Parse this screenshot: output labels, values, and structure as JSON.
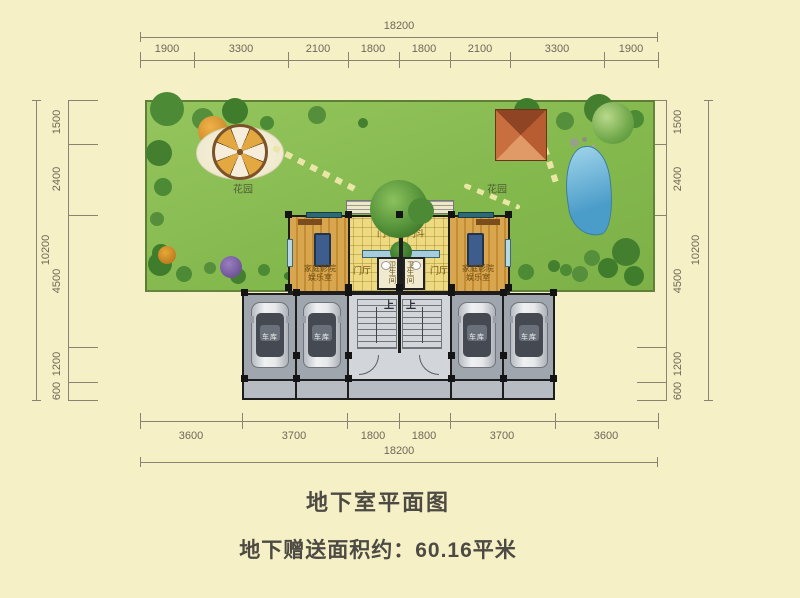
{
  "page": {
    "title": "地下室平面图",
    "subtitle": "地下赠送面积约：60.16平米"
  },
  "dims": {
    "top": {
      "overall": "18200",
      "segments": [
        "1900",
        "3300",
        "2100",
        "1800",
        "1800",
        "2100",
        "3300",
        "1900"
      ]
    },
    "bottom": {
      "overall": "18200",
      "segments": [
        "3600",
        "3700",
        "1800",
        "1800",
        "3700",
        "3600"
      ]
    },
    "left": {
      "overall": "10200",
      "segments": [
        "1500",
        "2400",
        "4500",
        "1200",
        "600"
      ]
    },
    "right": {
      "overall": "10200",
      "segments": [
        "1500",
        "2400",
        "4500",
        "1200",
        "600"
      ]
    }
  },
  "labels": {
    "garden": "花园",
    "entry_vestibule": "门斗",
    "foyer": "门厅",
    "bathroom": "卫生间",
    "theater_line1": "家庭影院",
    "theater_line2": "娱乐室",
    "garage": "车库",
    "stair_up": "上"
  },
  "colors": {
    "background": "#f6f0c6",
    "garden_green": "#83b84d",
    "tile_floor": "#eeda80",
    "wood_floor": "#d8a64e",
    "garage_gray": "#a0a6ae",
    "wall_black": "#1e1e1e",
    "pyramid_terracotta": "#c96f3f",
    "pond_blue": "#4a9cc9",
    "dim_text": "#6f6758",
    "title_text": "#4c4a42"
  }
}
